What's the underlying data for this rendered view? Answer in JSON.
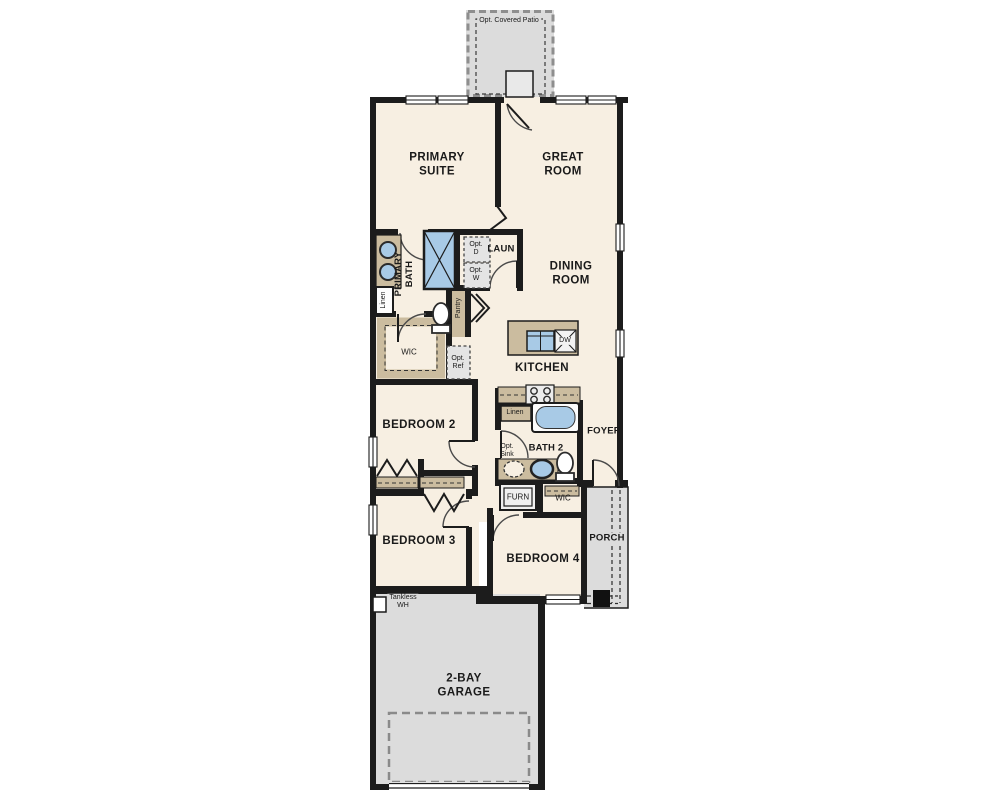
{
  "plan": {
    "labels": {
      "opt_covered_patio": "Opt. Covered Patio",
      "primary_suite": "PRIMARY\nSUITE",
      "great_room": "GREAT\nROOM",
      "primary_bath": "PRIMARY\nBATH",
      "laundry": "LAUN",
      "opt_dryer": "Opt.\nD",
      "opt_washer": "Opt.\nW",
      "linen_primary": "Linen",
      "pantry": "Pantry",
      "dining_room": "DINING\nROOM",
      "wic_primary": "WIC",
      "opt_ref": "Opt.\nRef",
      "kitchen": "KITCHEN",
      "dishwasher": "DW",
      "bedroom_2": "BEDROOM 2",
      "linen_bath2": "Linen",
      "bath_2": "BATH 2",
      "opt_sink": "Opt.\nSink",
      "foyer": "FOYER",
      "furnace": "FURN",
      "wic_bedroom4": "WIC",
      "porch": "PORCH",
      "bedroom_3": "BEDROOM 3",
      "bedroom_4": "BEDROOM 4",
      "tankless_wh": "Tankless\nWH",
      "garage": "2-BAY\nGARAGE"
    },
    "palette": {
      "room_fill": "#f7efe2",
      "outdoor_fill": "#dcdcdc",
      "wall": "#1c1c1c",
      "counter_tan": "#cbbc9f",
      "fixture_blue": "#a8cae6",
      "optional_box_fill": "#e4e4e4"
    }
  }
}
